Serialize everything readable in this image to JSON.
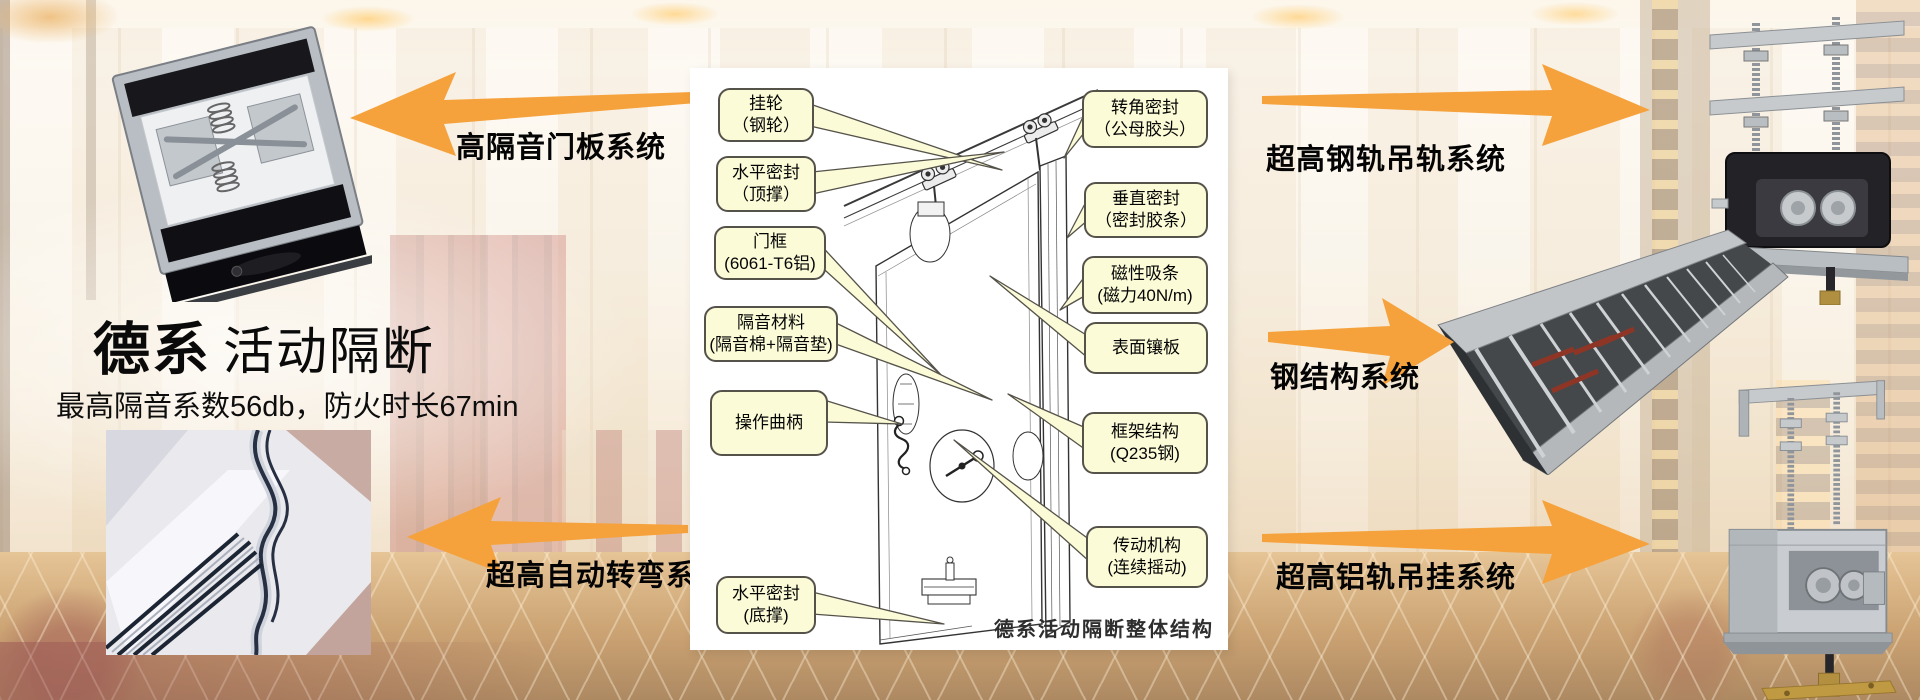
{
  "title": {
    "bold": "德系",
    "rest": "活动隔断",
    "subtitle": "最高隔音系数56db，防火时长67min"
  },
  "arrow_labels": {
    "top_left": "高隔音门板系统",
    "bottom_left": "超高自动转弯系统",
    "top_right": "超高钢轨吊轨系统",
    "mid_right": "钢结构系统",
    "bottom_right": "超高铝轨吊挂系统"
  },
  "diagram": {
    "caption": "德系活动隔断整体结构",
    "left_callouts": [
      [
        "挂轮",
        "（钢轮）"
      ],
      [
        "水平密封",
        "（顶撑）"
      ],
      [
        "门框",
        "(6061-T6铝)"
      ],
      [
        "隔音材料",
        "(隔音棉+隔音垫)"
      ],
      [
        "操作曲柄"
      ],
      [
        "水平密封",
        "(底撑)"
      ]
    ],
    "right_callouts": [
      [
        "转角密封",
        "（公母胶头）"
      ],
      [
        "垂直密封",
        "（密封胶条）"
      ],
      [
        "磁性吸条",
        "(磁力40N/m)"
      ],
      [
        "表面镶板"
      ],
      [
        "框架结构",
        "(Q235钢)"
      ],
      [
        "传动机构",
        "(连续摇动)"
      ]
    ]
  },
  "colors": {
    "arrow": "#F6A23C",
    "callout_bg": "#FBFBD8",
    "callout_border": "#55524a"
  }
}
